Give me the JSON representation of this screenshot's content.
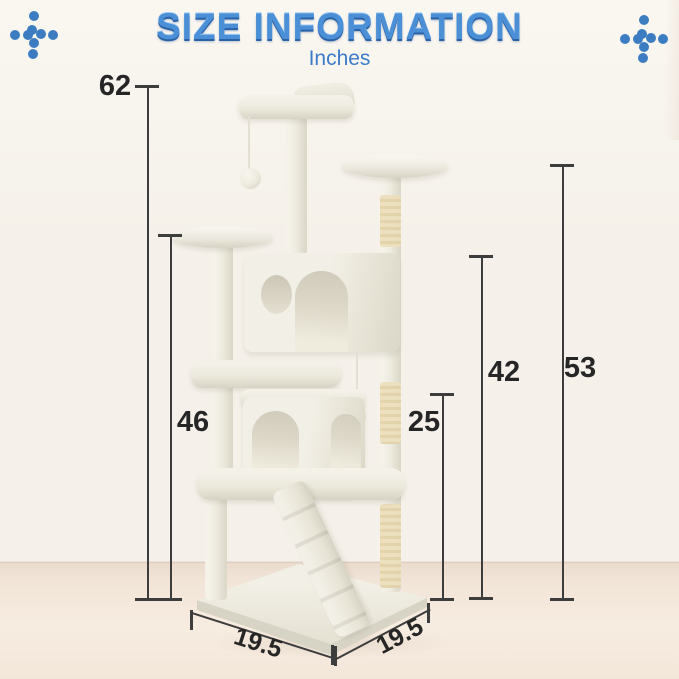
{
  "header": {
    "title": "SIZE INFORMATION",
    "subtitle": "Inches"
  },
  "dimensions": {
    "overall_height": "62",
    "left_perch_height": "46",
    "scratch_post_height": "25",
    "upper_condo_top_height": "42",
    "right_perch_height": "53",
    "base_depth": "19.5",
    "base_width": "19.5"
  },
  "icons": {
    "decoration": "dots-cross-icon"
  },
  "colors": {
    "title_blue": "#4b90d6",
    "subtitle_blue": "#3c7bca",
    "dot_blue": "#3c7cc1",
    "line_dark": "#3d3d3d",
    "label_dark": "#262626",
    "wall": "#f5f1ea",
    "wall_top": "#faf7f1",
    "sisal": "#ecdfbd"
  }
}
